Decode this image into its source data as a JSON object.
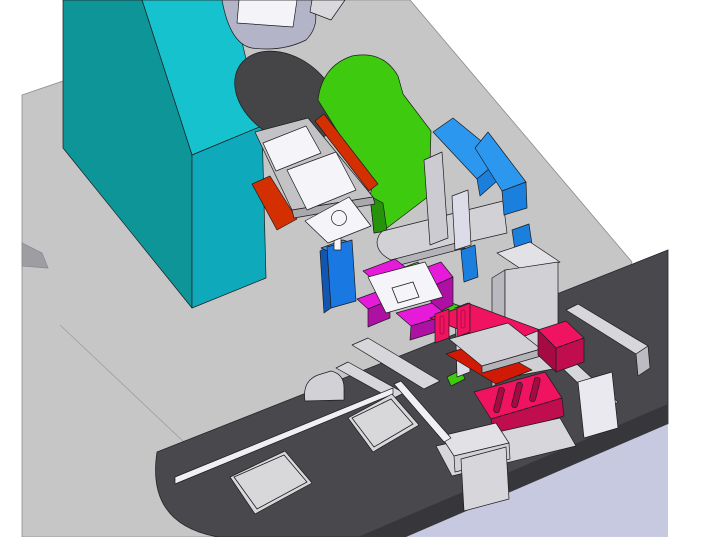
{
  "scene": {
    "kind": "3d-cad-assembly-render",
    "parts": [
      "machine-base-plate",
      "conveyor-slab",
      "shop-floor",
      "support-column",
      "motor-housing",
      "drive-roller",
      "cam-plate-green",
      "orange-guide-rail",
      "fixture-plate",
      "fixture-pads",
      "sensor-plate",
      "actuator-block-blue",
      "chute-plates-blue",
      "gripper-blocks-magenta",
      "workpiece-plate",
      "slide-carriage-crimson",
      "slotted-plate-crimson",
      "stopper-red",
      "linear-rails",
      "carriage-clamp",
      "pallets"
    ]
  },
  "colors": {
    "bg": "#ffffff",
    "base_plate": "#c6c6c6",
    "base_edge": "#9d9da2",
    "slab_top": "#49494d",
    "slab_front": "#37373b",
    "floor": "#c7c9e0",
    "teal_dark": "#0d9598",
    "teal_top": "#16c2ce",
    "teal_side": "#0fa9bc",
    "roller": "#454547",
    "motor": "#b4b4c8",
    "label": "#f4f4f8",
    "silver": "#d8d8dd",
    "green": "#3ecb0f",
    "green_dark": "#27930a",
    "orange": "#d32f00",
    "fixture_gray": "#c3c3c5",
    "fixture_side": "#a9a9ad",
    "white_part": "#f5f5f9",
    "cam_gray": "#d2d2d6",
    "cam_side": "#b3b3b9",
    "blue_plate": "#2b97ef",
    "blue_plate_low": "#1b7fdd",
    "wall_gray": "#cbcbd1",
    "wall_lav": "#dcdce8",
    "box_blue_front": "#1a78e2",
    "box_blue_side": "#1157b2",
    "box_blue_top": "#3c92ea",
    "magenta": "#e61ad9",
    "magenta_front": "#ae10a4",
    "crimson": "#f0135f",
    "crimson_front": "#bf0d4d",
    "crimson_deep": "#a50a43",
    "red": "#d11a05",
    "block_top": "#e2e2e6",
    "block_front": "#d0d0d5",
    "block_side": "#b8b8be",
    "rail_gray": "#d6d6db",
    "rail_side": "#bbbbc1",
    "end_white": "#e9e9ef",
    "rod_white": "#f0f0f4",
    "pallet": "#d8d8da",
    "outline": "#1c1c1e"
  }
}
